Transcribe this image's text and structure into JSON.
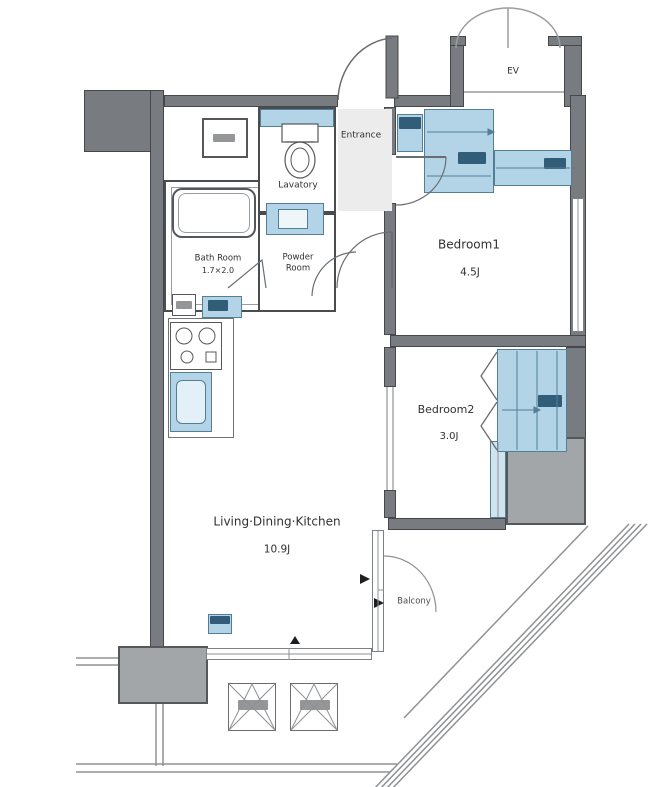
{
  "title": "Apartment Floor Plan",
  "rooms": {
    "ldk": {
      "name": "Living·Dining·Kitchen",
      "area": "10.9J"
    },
    "bedroom1": {
      "name": "Bedroom1",
      "area": "4.5J"
    },
    "bedroom2": {
      "name": "Bedroom2",
      "area": "3.0J"
    },
    "bath": {
      "name": "Bath Room",
      "size": "1.7×2.0"
    },
    "powder": {
      "name": "Powder Room"
    },
    "lavatory": {
      "name": "Lavatory"
    },
    "entrance": {
      "name": "Entrance"
    },
    "elevator": {
      "name": "EV"
    },
    "balcony": {
      "name": "Balcony"
    }
  },
  "colors": {
    "wall": "#787c80",
    "column": "#a3a6a9",
    "fixture_blue": "#b3d4e6",
    "fixture_blue_light": "#cfe4ef",
    "navy_label": "#24506b",
    "thin_line": "#8f9294",
    "text": "#2f3133",
    "background": "#ffffff"
  }
}
